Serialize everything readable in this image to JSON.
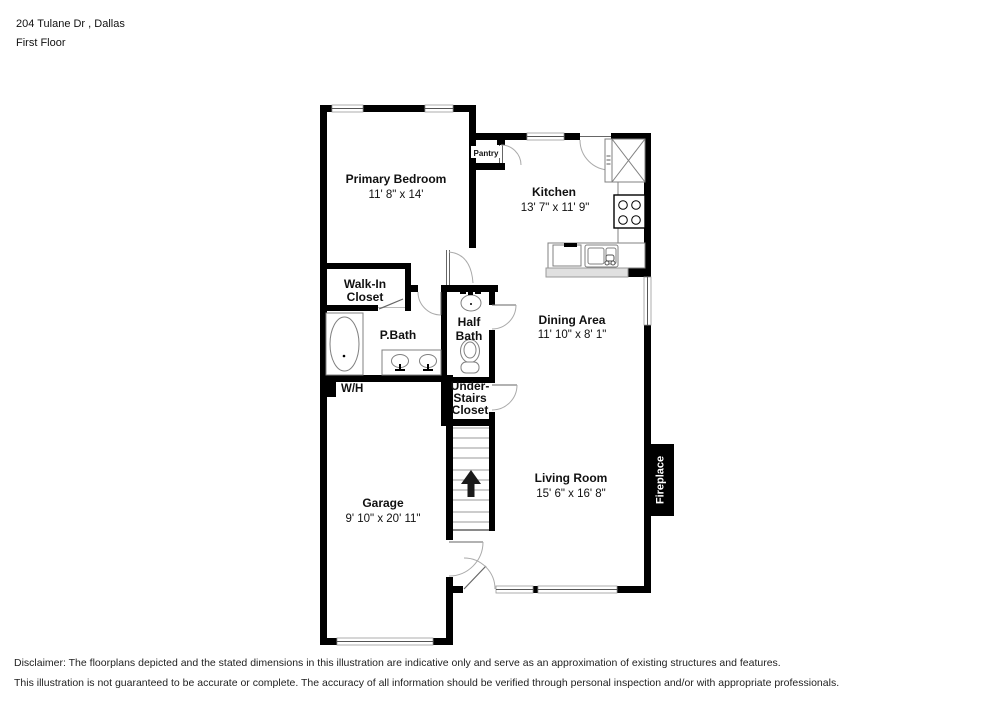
{
  "header": {
    "address": "204 Tulane Dr , Dallas",
    "floor": "First Floor"
  },
  "rooms": {
    "primary_bedroom": {
      "name": "Primary Bedroom",
      "dims": "11' 8\" x 14'"
    },
    "kitchen": {
      "name": "Kitchen",
      "dims": "13' 7\" x 11' 9\""
    },
    "dining": {
      "name": "Dining Area",
      "dims": "11' 10\" x 8' 1\""
    },
    "living": {
      "name": "Living Room",
      "dims": "15' 6\" x 16' 8\""
    },
    "garage": {
      "name": "Garage",
      "dims": "9' 10\" x 20' 11\""
    },
    "walk_in_closet": {
      "line1": "Walk-In",
      "line2": "Closet"
    },
    "p_bath": {
      "name": "P.Bath"
    },
    "half_bath": {
      "line1": "Half",
      "line2": "Bath"
    },
    "under_stairs": {
      "line1": "Under-",
      "line2": "Stairs",
      "line3": "Closet"
    },
    "pantry": {
      "name": "Pantry"
    },
    "water_heater": {
      "name": "W/H"
    },
    "fireplace": {
      "name": "Fireplace"
    }
  },
  "disclaimer": {
    "line1": "Disclaimer: The floorplans depicted and the stated dimensions in this illustration are indicative only and serve as an approximation of existing structures and features.",
    "line2": "This illustration is not guaranteed to be accurate or complete. The accuracy of all information should be verified through personal inspection and/or with appropriate professionals."
  },
  "colors": {
    "wall": "#000000",
    "fixture_line": "#808080",
    "door_arc": "#aaaaaa",
    "counter_fill": "#e0e0e0",
    "fireplace_bg": "#000000",
    "fireplace_text": "#ffffff"
  }
}
